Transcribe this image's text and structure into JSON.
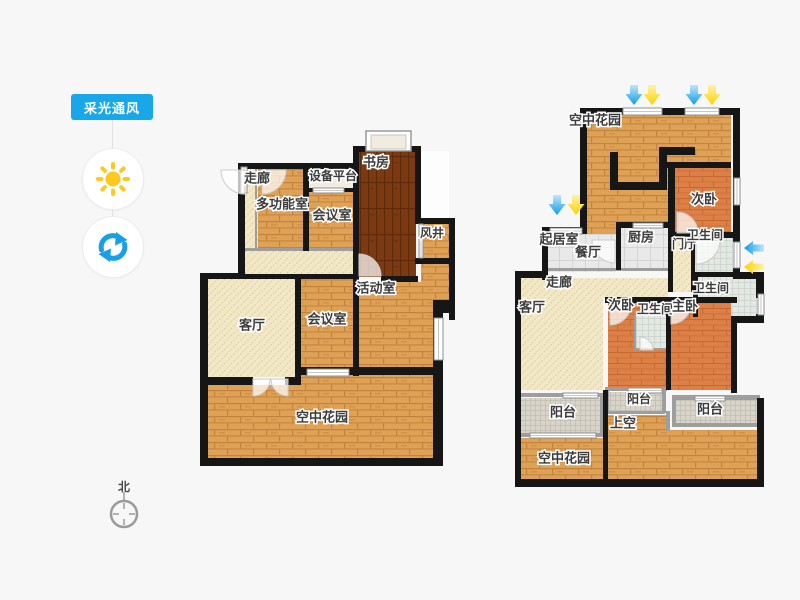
{
  "sidebar": {
    "tool_label": "采光通风",
    "accent": "#18a7e8",
    "sun_color": "#fec91e",
    "refresh_color": "#179fe8"
  },
  "compass": {
    "label": "北"
  },
  "palette": {
    "wall": "#161616",
    "thin_wall": "#9e9e9e",
    "wood": "#dfa156",
    "wood_line": "#c2833c",
    "dark_wood": "#7c3a13",
    "dark_wood_line": "#5f2a0a",
    "salmon": "#dd8048",
    "salmon_line": "#c66a34",
    "hatch_bg": "#f2e8c5",
    "hatch_line": "#d9c9a0",
    "tile": "#e9e9e9",
    "tile_line": "#d5d5d5",
    "bath_tile": "#e3e8e3",
    "bath_tile_line": "#c9d3cb",
    "dot_tile": "#d8d4c9",
    "dot_tile_line": "#c2beb2",
    "plain_room": "#f1ecdf",
    "white_room": "#fdfdfd",
    "window_fill": "#ffffff",
    "window_stroke": "#8f8f8f",
    "door_stroke": "#cccccc",
    "label_color": "#3c3c3c",
    "arrow_blue": "#0d9be8",
    "arrow_blue_light": "#bfe6fb",
    "arrow_yellow": "#ffd100",
    "arrow_yellow_light": "#fdf3a8"
  },
  "floorplan": {
    "rooms": [
      {
        "n": "corridor-2f",
        "t": "hatch",
        "x": 245,
        "y": 168,
        "w": 13,
        "h": 82
      },
      {
        "n": "walkway-2f",
        "t": "hatch",
        "x": 245,
        "y": 250,
        "w": 110,
        "h": 26
      },
      {
        "n": "multifunction-room",
        "t": "wood",
        "x": 258,
        "y": 168,
        "w": 47,
        "h": 82
      },
      {
        "n": "equipment-platform",
        "t": "plain",
        "x": 307,
        "y": 167,
        "w": 50,
        "h": 23
      },
      {
        "n": "meeting-room-upper",
        "t": "wood",
        "x": 309,
        "y": 192,
        "w": 44,
        "h": 58
      },
      {
        "n": "study",
        "t": "darkwood",
        "x": 358,
        "y": 151,
        "w": 58,
        "h": 126
      },
      {
        "n": "void-space",
        "t": "white",
        "x": 421,
        "y": 151,
        "w": 28,
        "h": 67
      },
      {
        "n": "wind-shaft",
        "t": "wood",
        "x": 420,
        "y": 224,
        "w": 30,
        "h": 34
      },
      {
        "n": "activity-room",
        "t": "wood",
        "x": 358,
        "y": 282,
        "w": 75,
        "h": 85
      },
      {
        "n": "activity-room-ext",
        "t": "wood",
        "x": 421,
        "y": 264,
        "w": 28,
        "h": 49
      },
      {
        "n": "living-room-2f",
        "t": "hatch",
        "x": 207,
        "y": 279,
        "w": 88,
        "h": 98
      },
      {
        "n": "meeting-room-lower",
        "t": "wood",
        "x": 301,
        "y": 279,
        "w": 52,
        "h": 88
      },
      {
        "n": "sky-garden-2f",
        "t": "wood",
        "x": 207,
        "y": 385,
        "w": 236,
        "h": 73
      },
      {
        "n": "sky-garden-2f-top",
        "t": "wood",
        "x": 295,
        "y": 375,
        "w": 148,
        "h": 10
      },
      {
        "n": "sky-garden-3f-top",
        "t": "wood",
        "x": 587,
        "y": 115,
        "w": 144,
        "h": 120
      },
      {
        "n": "bedroom-2-top",
        "t": "salmon",
        "x": 675,
        "y": 168,
        "w": 56,
        "h": 67
      },
      {
        "n": "sitting-dining-room",
        "t": "tile",
        "x": 548,
        "y": 234,
        "w": 68,
        "h": 38
      },
      {
        "n": "kitchen",
        "t": "tile",
        "x": 621,
        "y": 228,
        "w": 47,
        "h": 40
      },
      {
        "n": "foyer",
        "t": "hatch",
        "x": 673,
        "y": 238,
        "w": 18,
        "h": 54
      },
      {
        "n": "bathroom-top",
        "t": "bathtile",
        "x": 695,
        "y": 238,
        "w": 38,
        "h": 34
      },
      {
        "n": "hallway-3f",
        "t": "hatch",
        "x": 521,
        "y": 278,
        "w": 147,
        "h": 20
      },
      {
        "n": "living-room-3f",
        "t": "hatch",
        "x": 521,
        "y": 298,
        "w": 82,
        "h": 92
      },
      {
        "n": "bathroom-master",
        "t": "bathtile",
        "x": 698,
        "y": 277,
        "w": 59,
        "h": 39
      },
      {
        "n": "bedroom-2-mid",
        "t": "salmon",
        "x": 608,
        "y": 303,
        "w": 58,
        "h": 87
      },
      {
        "n": "bathroom-small",
        "t": "bathtile",
        "x": 636,
        "y": 315,
        "w": 30,
        "h": 35
      },
      {
        "n": "master-bedroom",
        "t": "salmon",
        "x": 671,
        "y": 303,
        "w": 60,
        "h": 87
      },
      {
        "n": "balcony-left",
        "t": "dottile",
        "x": 521,
        "y": 398,
        "w": 79,
        "h": 35
      },
      {
        "n": "sky-garden-3f-bottom",
        "t": "wood",
        "x": 521,
        "y": 438,
        "w": 82,
        "h": 41
      },
      {
        "n": "balcony-mid",
        "t": "dottile",
        "x": 609,
        "y": 392,
        "w": 55,
        "h": 19
      },
      {
        "n": "open-above",
        "t": "wood",
        "x": 608,
        "y": 415,
        "w": 58,
        "h": 64
      },
      {
        "n": "open-above-ext",
        "t": "wood",
        "x": 666,
        "y": 430,
        "w": 91,
        "h": 49
      },
      {
        "n": "balcony-right",
        "t": "dottile",
        "x": 676,
        "y": 400,
        "w": 81,
        "h": 25
      }
    ],
    "walls": [
      [
        238,
        163,
        120,
        6
      ],
      [
        353,
        146,
        68,
        6
      ],
      [
        353,
        152,
        6,
        224
      ],
      [
        415,
        152,
        6,
        72
      ],
      [
        415,
        218,
        40,
        6
      ],
      [
        449,
        224,
        6,
        96
      ],
      [
        433,
        300,
        22,
        13
      ],
      [
        433,
        313,
        10,
        152
      ],
      [
        415,
        258,
        34,
        6
      ],
      [
        200,
        458,
        243,
        8
      ],
      [
        200,
        273,
        8,
        193
      ],
      [
        238,
        163,
        7,
        116
      ],
      [
        200,
        273,
        45,
        6
      ],
      [
        303,
        163,
        6,
        88
      ],
      [
        305,
        188,
        54,
        4
      ],
      [
        381,
        276,
        37,
        6
      ],
      [
        207,
        274,
        146,
        5
      ],
      [
        295,
        279,
        6,
        99
      ],
      [
        295,
        367,
        148,
        8
      ],
      [
        207,
        377,
        46,
        8
      ],
      [
        285,
        377,
        16,
        8
      ],
      [
        580,
        108,
        160,
        7
      ],
      [
        580,
        108,
        7,
        126
      ],
      [
        542,
        227,
        45,
        7
      ],
      [
        542,
        230,
        6,
        50
      ],
      [
        515,
        271,
        33,
        7
      ],
      [
        515,
        271,
        6,
        125
      ],
      [
        515,
        393,
        6,
        94
      ],
      [
        515,
        479,
        249,
        8
      ],
      [
        733,
        108,
        7,
        134
      ],
      [
        733,
        268,
        7,
        10
      ],
      [
        733,
        272,
        28,
        7
      ],
      [
        756,
        272,
        8,
        26
      ],
      [
        756,
        314,
        8,
        9
      ],
      [
        733,
        316,
        28,
        7
      ],
      [
        731,
        316,
        6,
        77
      ],
      [
        757,
        398,
        7,
        89
      ],
      [
        666,
        162,
        65,
        6
      ],
      [
        668,
        168,
        7,
        67
      ],
      [
        610,
        152,
        8,
        38
      ],
      [
        610,
        182,
        50,
        8
      ],
      [
        659,
        147,
        36,
        8
      ],
      [
        659,
        147,
        8,
        43
      ],
      [
        616,
        222,
        57,
        6
      ],
      [
        616,
        228,
        5,
        42
      ],
      [
        668,
        222,
        5,
        70
      ],
      [
        691,
        232,
        4,
        60
      ],
      [
        673,
        232,
        60,
        6
      ],
      [
        695,
        272,
        62,
        5
      ],
      [
        605,
        297,
        132,
        6
      ],
      [
        666,
        303,
        5,
        87
      ],
      [
        693,
        277,
        5,
        40
      ],
      [
        603,
        390,
        5,
        90
      ]
    ],
    "thin_walls": [
      [
        255,
        168,
        2,
        80
      ],
      [
        245,
        248,
        110,
        3
      ],
      [
        545,
        268,
        125,
        3
      ],
      [
        636,
        313,
        32,
        2
      ],
      [
        634,
        315,
        2,
        36
      ],
      [
        636,
        348,
        30,
        2
      ],
      [
        518,
        393,
        86,
        4
      ],
      [
        518,
        433,
        87,
        4
      ],
      [
        600,
        393,
        4,
        44
      ],
      [
        605,
        387,
        62,
        4
      ],
      [
        605,
        387,
        4,
        26
      ],
      [
        662,
        387,
        4,
        26
      ],
      [
        607,
        411,
        58,
        3
      ],
      [
        672,
        395,
        88,
        5
      ],
      [
        672,
        395,
        4,
        31
      ],
      [
        672,
        423,
        88,
        4
      ],
      [
        666,
        411,
        4,
        20
      ]
    ],
    "windows": [
      [
        241,
        167,
        6,
        26
      ],
      [
        313,
        188,
        31,
        5
      ],
      [
        307,
        369,
        42,
        7
      ],
      [
        434,
        318,
        9,
        42
      ],
      [
        419,
        224,
        4,
        34
      ],
      [
        623,
        108,
        39,
        7
      ],
      [
        685,
        108,
        34,
        7
      ],
      [
        550,
        228,
        32,
        6
      ],
      [
        734,
        178,
        6,
        27
      ],
      [
        734,
        242,
        6,
        26
      ],
      [
        758,
        294,
        6,
        21
      ],
      [
        563,
        393,
        35,
        5
      ],
      [
        628,
        388,
        34,
        5
      ],
      [
        695,
        396,
        30,
        5
      ],
      [
        530,
        433,
        66,
        5
      ],
      [
        633,
        223,
        30,
        5
      ]
    ],
    "doors": [
      [
        245,
        170,
        24,
        90,
        180
      ],
      [
        262,
        170,
        24,
        0,
        90
      ],
      [
        359,
        276,
        22,
        270,
        360
      ],
      [
        253,
        379,
        17,
        0,
        90
      ],
      [
        288,
        379,
        17,
        90,
        180
      ],
      [
        615,
        240,
        23,
        90,
        180
      ],
      [
        677,
        233,
        21,
        270,
        360
      ],
      [
        696,
        240,
        24,
        0,
        90
      ],
      [
        610,
        304,
        21,
        0,
        90
      ],
      [
        671,
        304,
        20,
        0,
        90
      ],
      [
        640,
        350,
        13,
        270,
        360
      ]
    ],
    "ac_platform_box": [
      366,
      131,
      45,
      20
    ],
    "labels": [
      {
        "t": "走廊",
        "x": 257,
        "y": 179
      },
      {
        "t": "设备平台",
        "x": 333,
        "y": 177,
        "s": 12
      },
      {
        "t": "书房",
        "x": 376,
        "y": 163
      },
      {
        "t": "多功能室",
        "x": 282,
        "y": 205
      },
      {
        "t": "会议室",
        "x": 332,
        "y": 216
      },
      {
        "t": "风井",
        "x": 432,
        "y": 234,
        "s": 12
      },
      {
        "t": "活动室",
        "x": 376,
        "y": 289
      },
      {
        "t": "客厅",
        "x": 252,
        "y": 326
      },
      {
        "t": "会议室",
        "x": 327,
        "y": 320
      },
      {
        "t": "空中花园",
        "x": 322,
        "y": 418
      },
      {
        "t": "空中花园",
        "x": 595,
        "y": 121
      },
      {
        "t": "次卧",
        "x": 704,
        "y": 200
      },
      {
        "t": "起居室",
        "x": 559,
        "y": 240
      },
      {
        "t": "餐厅",
        "x": 588,
        "y": 253
      },
      {
        "t": "厨房",
        "x": 641,
        "y": 238
      },
      {
        "t": "门厅",
        "x": 684,
        "y": 245,
        "s": 12
      },
      {
        "t": "卫生间",
        "x": 705,
        "y": 236,
        "s": 12
      },
      {
        "t": "走廊",
        "x": 559,
        "y": 283
      },
      {
        "t": "客厅",
        "x": 532,
        "y": 308
      },
      {
        "t": "次卧",
        "x": 621,
        "y": 306
      },
      {
        "t": "卫生间",
        "x": 655,
        "y": 310,
        "s": 12
      },
      {
        "t": "主卧",
        "x": 685,
        "y": 307
      },
      {
        "t": "卫生间",
        "x": 711,
        "y": 289,
        "s": 12
      },
      {
        "t": "阳台",
        "x": 563,
        "y": 413
      },
      {
        "t": "空中花园",
        "x": 564,
        "y": 459
      },
      {
        "t": "阳台",
        "x": 639,
        "y": 400,
        "s": 12
      },
      {
        "t": "上空",
        "x": 623,
        "y": 424
      },
      {
        "t": "阳台",
        "x": 710,
        "y": 410
      }
    ],
    "arrows": [
      {
        "d": "down",
        "c": "blue",
        "x": 634,
        "y": 85
      },
      {
        "d": "down",
        "c": "yellow",
        "x": 652,
        "y": 85
      },
      {
        "d": "down",
        "c": "blue",
        "x": 694,
        "y": 85
      },
      {
        "d": "down",
        "c": "yellow",
        "x": 712,
        "y": 85
      },
      {
        "d": "down",
        "c": "blue",
        "x": 557,
        "y": 195
      },
      {
        "d": "down",
        "c": "yellow",
        "x": 576,
        "y": 195
      },
      {
        "d": "left",
        "c": "blue",
        "x": 744,
        "y": 248
      },
      {
        "d": "left",
        "c": "yellow",
        "x": 744,
        "y": 267
      }
    ]
  }
}
